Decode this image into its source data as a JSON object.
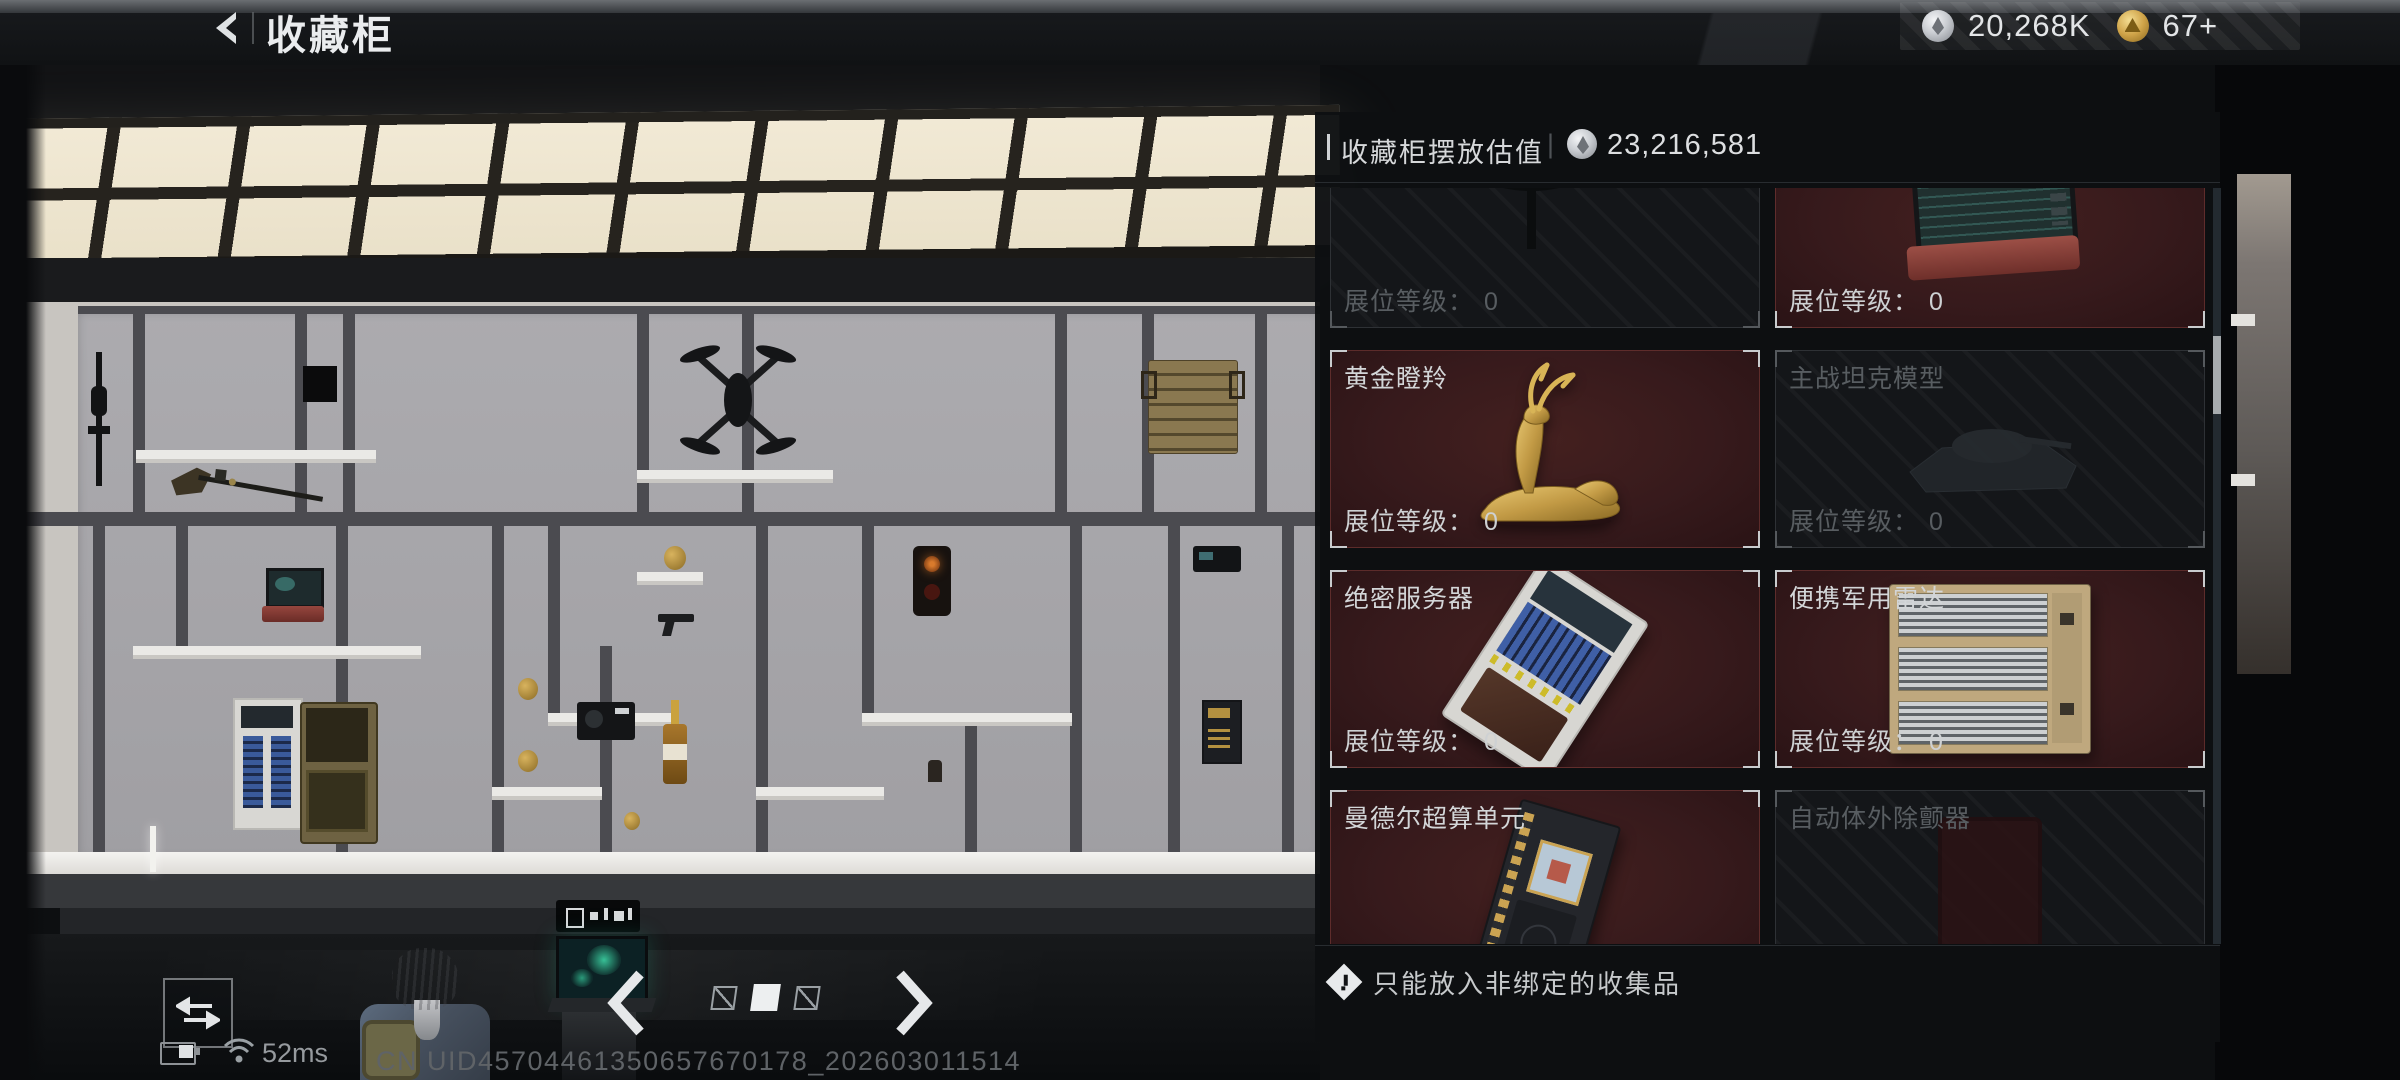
{
  "top_bar": {
    "title": "收藏柜",
    "back_icon": "back-arrow-icon",
    "currencies": [
      {
        "icon": "silver-coin",
        "value": "20,268K"
      },
      {
        "icon": "gold-coin",
        "value": "67+"
      }
    ]
  },
  "valuation_panel": {
    "header": {
      "title": "收藏柜摆放估值",
      "separator": "|",
      "coin_icon": "silver-coin",
      "value": "23,216,581"
    },
    "slot_level_label": "展位等级：",
    "cells": [
      {
        "name": "",
        "level": "0",
        "locked": true,
        "item_icon": "unknown-collectible"
      },
      {
        "name": "",
        "level": "0",
        "locked": false,
        "item_icon": "red-field-radio"
      },
      {
        "name": "黄金瞪羚",
        "level": "0",
        "locked": false,
        "item_icon": "golden-gazelle-statue"
      },
      {
        "name": "主战坦克模型",
        "level": "0",
        "locked": true,
        "item_icon": "tank-model"
      },
      {
        "name": "绝密服务器",
        "level": "0",
        "locked": false,
        "item_icon": "server-mainboard"
      },
      {
        "name": "便携军用雷达",
        "level": "0",
        "locked": false,
        "item_icon": "portable-radar"
      },
      {
        "name": "曼德尔超算单元",
        "level": "0",
        "locked": false,
        "item_icon": "compute-unit-board"
      },
      {
        "name": "自动体外除颤器",
        "level": "0",
        "locked": true,
        "item_icon": "aed-device"
      }
    ],
    "notice": {
      "icon": "alert-diamond-icon",
      "text": "只能放入非绑定的收集品"
    }
  },
  "pager": {
    "swap_icon": "swap-arrows-icon",
    "left_icon": "chevron-left-icon",
    "right_icon": "chevron-right-icon",
    "pages": [
      "inactive",
      "active",
      "inactive"
    ]
  },
  "status_bar": {
    "battery_icon": "battery-icon",
    "wifi_icon": "wifi-icon",
    "ping": "52ms",
    "session_id": "CN UID45704461350657670178_202603011514"
  },
  "scene": {
    "display_items": [
      "sniper-rifle",
      "antique-musket",
      "black-plaque",
      "field-radio",
      "drone",
      "military-crate",
      "gold-medal",
      "traffic-light",
      "pistol",
      "liquor-bottle",
      "mini-figure",
      "signal-device",
      "circuit-board",
      "server-tile",
      "field-case",
      "camera-device"
    ]
  }
}
